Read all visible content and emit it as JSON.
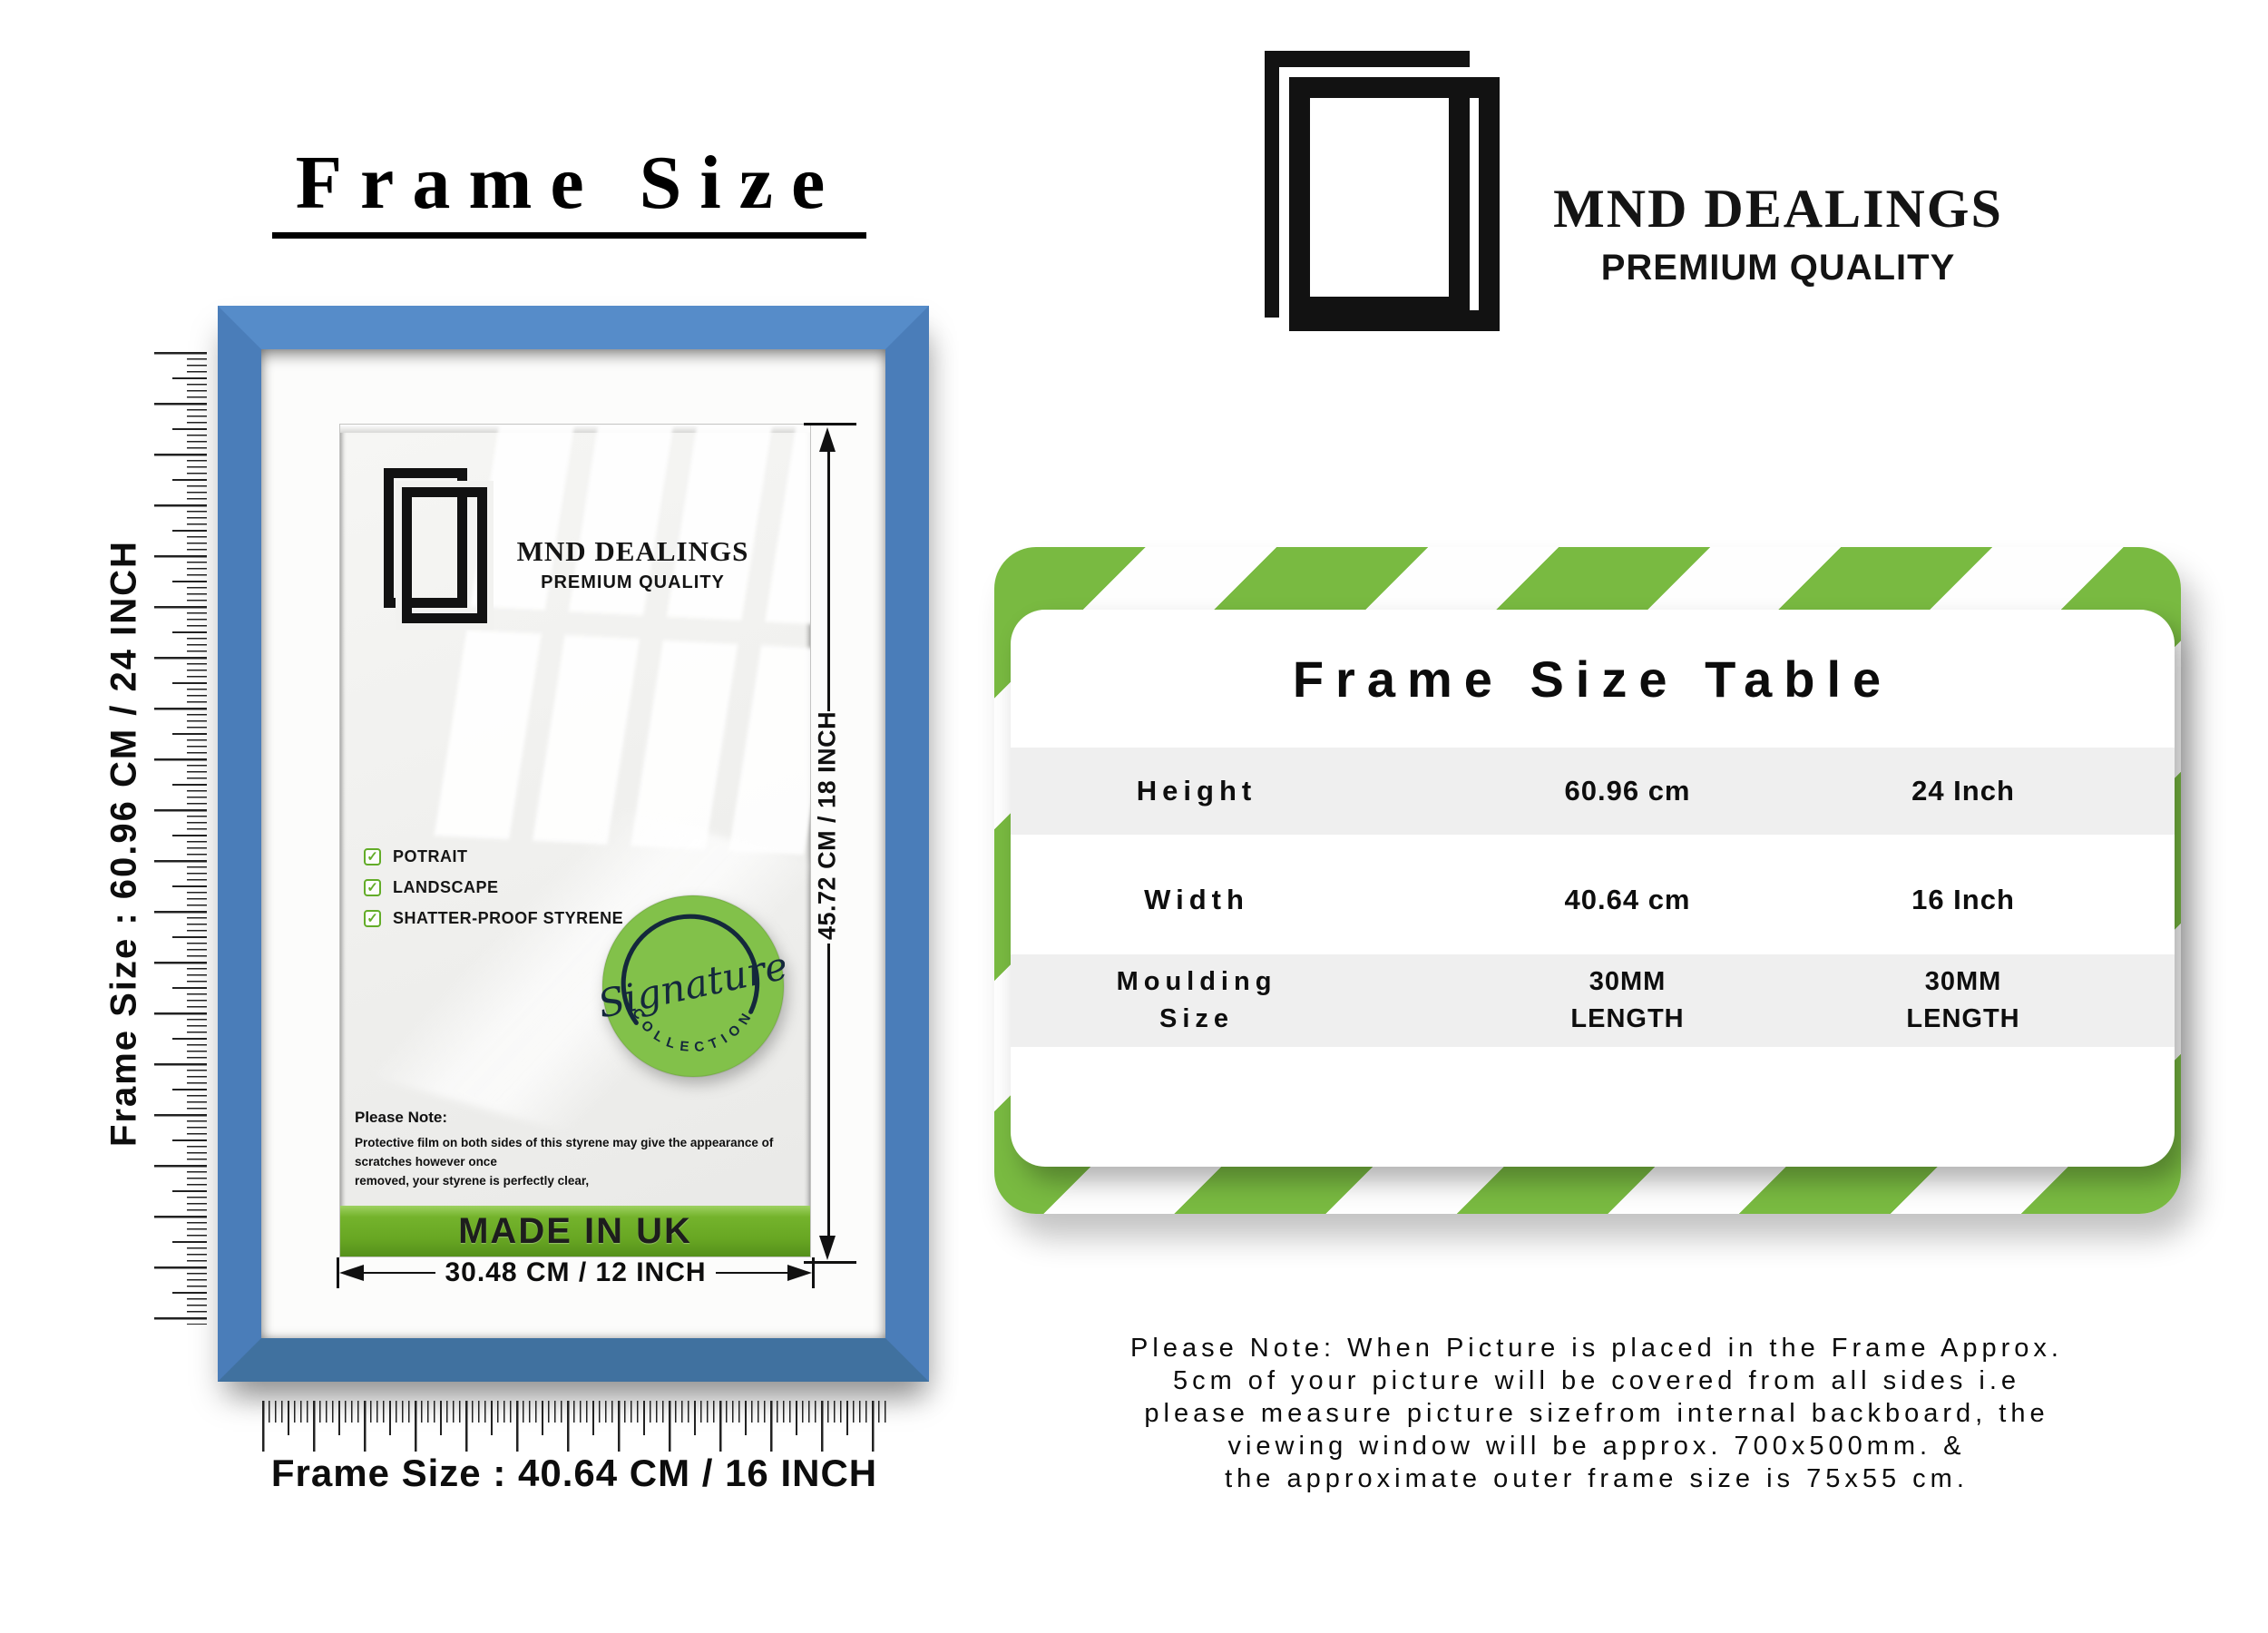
{
  "heading": {
    "title": "Frame Size"
  },
  "brand": {
    "name": "MND DEALINGS",
    "tagline": "PREMIUM QUALITY"
  },
  "frame_visual": {
    "left_label": "Frame Size : 60.96 CM / 24 INCH",
    "bottom_label": "Frame Size : 40.64 CM / 16 INCH",
    "poster": {
      "brand": "MND DEALINGS",
      "tagline": "PREMIUM QUALITY",
      "check_glyph": "✓",
      "features": [
        "POTRAIT",
        "LANDSCAPE",
        "SHATTER-PROOF STYRENE"
      ],
      "badge": {
        "script": "Signature",
        "arc": "COLLECTION"
      },
      "note_title": "Please Note:",
      "note_body_1": "Protective film on both sides of this styrene may give the appearance of scratches however once",
      "note_body_2": "removed, your styrene is perfectly clear,",
      "made_in": "MADE IN UK"
    },
    "dims": {
      "height": "45.72 CM / 18 INCH",
      "width": "30.48 CM / 12 INCH"
    }
  },
  "table": {
    "title": "Frame Size Table",
    "rows": [
      {
        "label": "Height",
        "metric": "60.96 cm",
        "imperial": "24 Inch"
      },
      {
        "label": "Width",
        "metric": "40.64 cm",
        "imperial": "16 Inch"
      },
      {
        "label": "Moulding\nSize",
        "metric": "30MM\nLENGTH",
        "imperial": "30MM\nLENGTH"
      }
    ]
  },
  "footnote": {
    "lines": [
      "Please Note: When Picture is placed in the Frame Approx.",
      "5cm of your picture will be covered from all sides i.e",
      "please measure picture sizefrom internal backboard, the",
      "viewing window will be approx. 700x500mm. &",
      "the approximate outer frame size is 75x55 cm."
    ]
  },
  "colors": {
    "frame_blue": "#4e82c0",
    "stripe_green": "#79ba41",
    "badge_green": "#82c14a",
    "banner_green": "#68a723",
    "row_gray": "#efefef"
  }
}
